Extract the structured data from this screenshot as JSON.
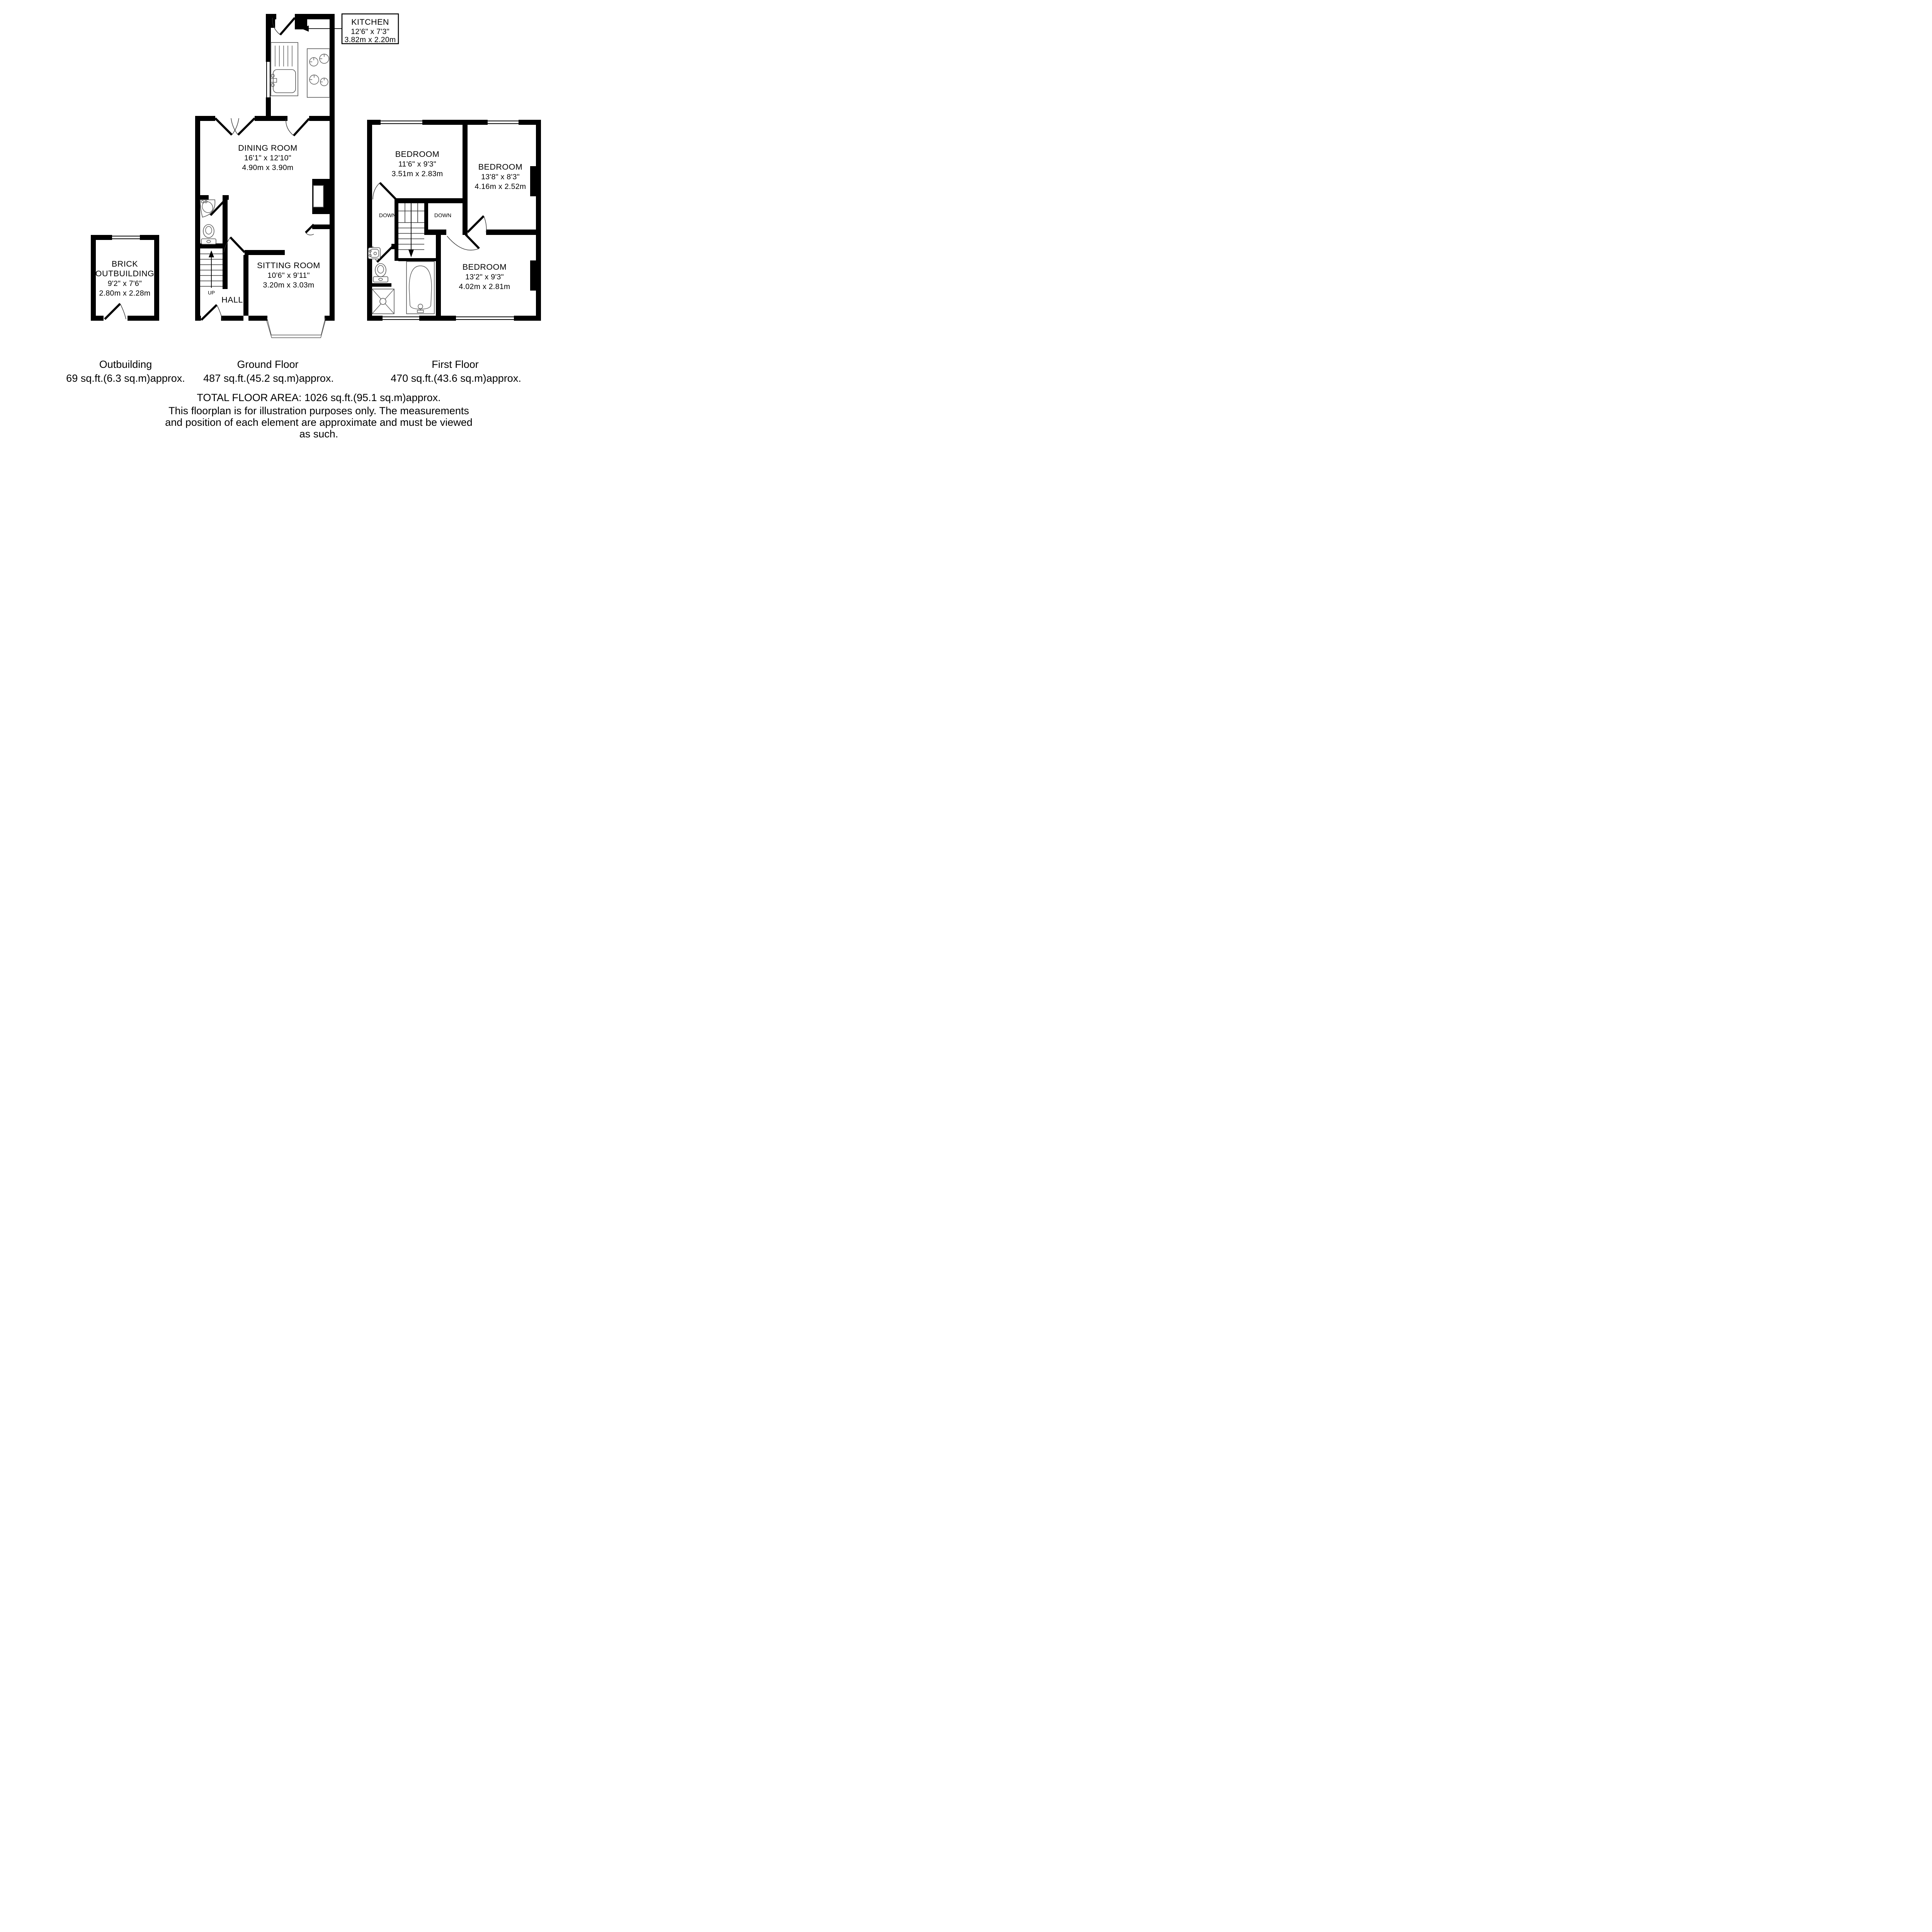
{
  "colors": {
    "walls": "#000000",
    "background": "#ffffff",
    "fixture_lines": "#555555"
  },
  "rooms": {
    "kitchen": {
      "name": "KITCHEN",
      "imperial": "12'6\" x 7'3\"",
      "metric": "3.82m x 2.20m"
    },
    "dining": {
      "name": "DINING ROOM",
      "imperial": "16'1\" x 12'10\"",
      "metric": "4.90m x 3.90m"
    },
    "sitting": {
      "name": "SITTING ROOM",
      "imperial": "10'6\" x 9'11\"",
      "metric": "3.20m x 3.03m"
    },
    "hall": {
      "name": "HALL"
    },
    "outbuilding": {
      "line1": "BRICK",
      "line2": "OUTBUILDING",
      "imperial": "9'2\" x 7'6\"",
      "metric": "2.80m x 2.28m"
    },
    "bedroom1": {
      "name": "BEDROOM",
      "imperial": "11'6\" x 9'3\"",
      "metric": "3.51m x 2.83m"
    },
    "bedroom2": {
      "name": "BEDROOM",
      "imperial": "13'8\" x 8'3\"",
      "metric": "4.16m x 2.52m"
    },
    "bedroom3": {
      "name": "BEDROOM",
      "imperial": "13'2\" x 9'3\"",
      "metric": "4.02m x 2.81m"
    }
  },
  "stairs": {
    "up": "UP",
    "down_left": "DOWN",
    "down_right": "DOWN"
  },
  "captions": {
    "outbuilding": {
      "title": "Outbuilding",
      "area": "69 sq.ft.(6.3 sq.m)approx."
    },
    "ground": {
      "title": "Ground Floor",
      "area": "487 sq.ft.(45.2 sq.m)approx."
    },
    "first": {
      "title": "First Floor",
      "area": "470 sq.ft.(43.6 sq.m)approx."
    }
  },
  "footer": {
    "total": "TOTAL FLOOR AREA: 1026 sq.ft.(95.1 sq.m)approx.",
    "disclaimer1": "This floorplan is for illustration purposes only. The measurements",
    "disclaimer2": "and position of each element are approximate and must be viewed",
    "disclaimer3": "as such."
  }
}
